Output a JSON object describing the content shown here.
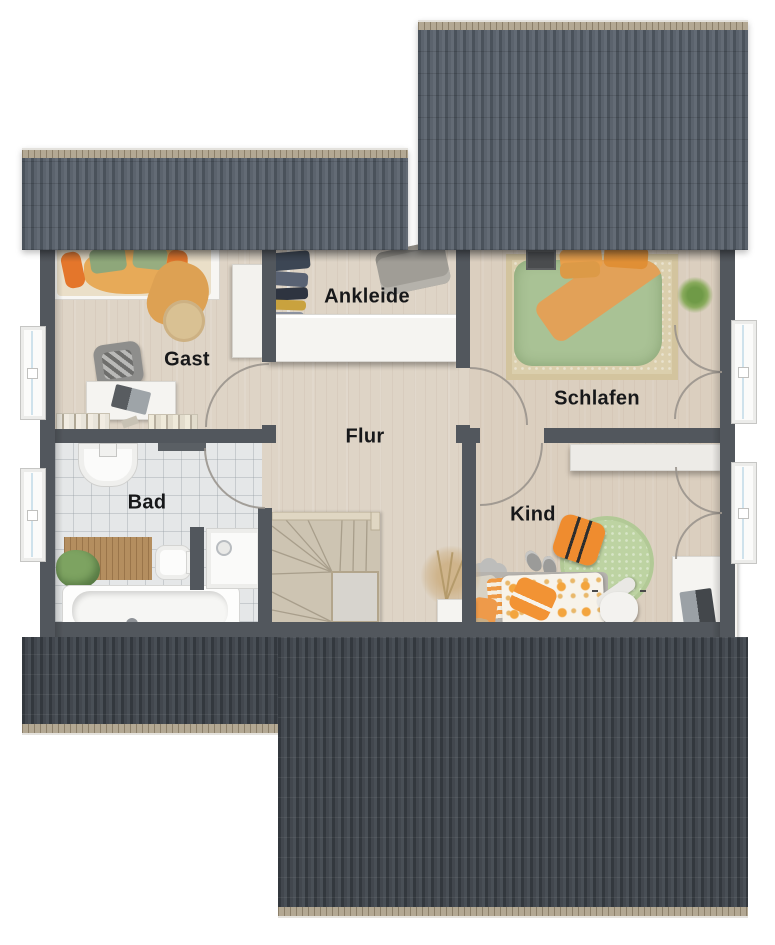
{
  "plan": {
    "type": "floor-plan-top-view",
    "rooms": [
      {
        "id": "gast",
        "label": "Gast"
      },
      {
        "id": "ankleide",
        "label": "Ankleide"
      },
      {
        "id": "schlafen",
        "label": "Schlafen"
      },
      {
        "id": "flur",
        "label": "Flur"
      },
      {
        "id": "bad",
        "label": "Bad"
      },
      {
        "id": "kind",
        "label": "Kind"
      }
    ],
    "colors": {
      "roof_top": "#59626c",
      "roof_bottom": "#42474e",
      "ridge_eave": "#b3a893",
      "wall": "#52575d",
      "floor_wood": "#ded4c6",
      "floor_tile": "#e5e7e8",
      "accent_orange": "#ef8c2f",
      "accent_green_duvet": "#a9c295",
      "accent_green_rug": "#bdd3a2",
      "label_text": "#17181a"
    }
  }
}
